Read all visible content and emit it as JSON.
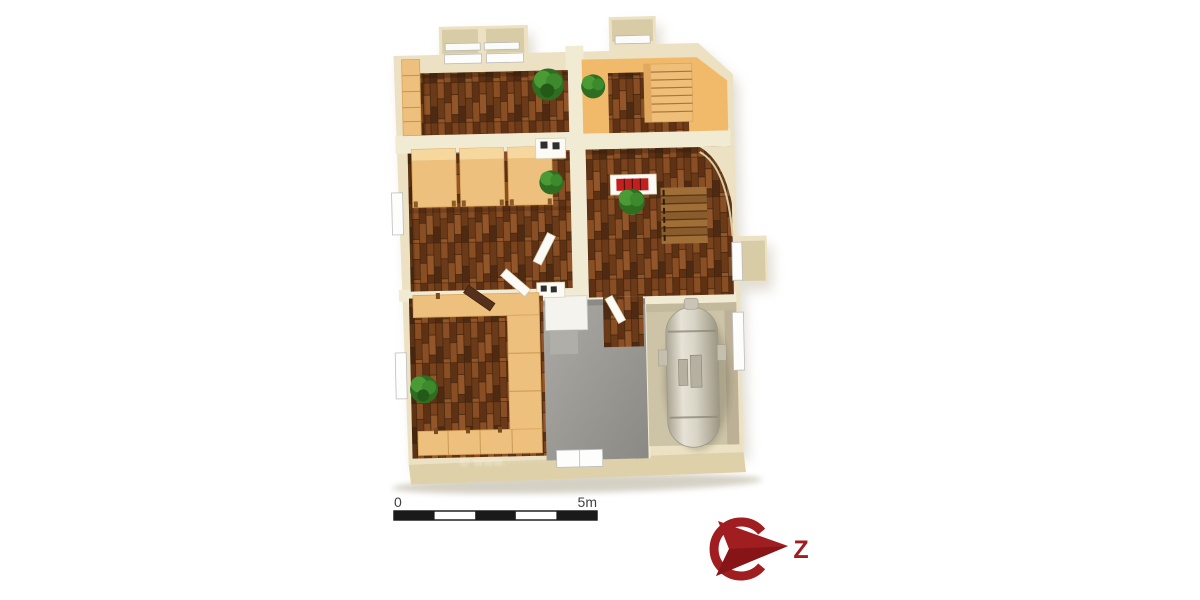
{
  "render": {
    "background": "#ffffff",
    "watermark_text": "© www.············"
  },
  "scale_bar": {
    "start_label": "0",
    "end_label": "5m",
    "segments": 5,
    "meters_total": 5,
    "dark_color": "#1a1a1a",
    "light_color": "#ffffff",
    "text_color": "#3f3f3f"
  },
  "compass": {
    "letter": "Z",
    "color": "#a01d20",
    "dark_color": "#871518"
  },
  "palette": {
    "wall": "#ece1c2",
    "wall_light": "#f2ebd4",
    "wall_shadow": "#d8cca6",
    "wall_front": "#ded1aa",
    "wood_dark": "#6f3c1b",
    "wood_furniture": "#eec07e",
    "floor_orange": "#f0ba6a",
    "floor_gray": "#9b9995",
    "floor_tank_room": "#cdc4a8",
    "plant_green": "#3f8f2c",
    "fireplace_red": "#c41f1f",
    "tank_metal": "#d6d2c4"
  },
  "floor_plan": {
    "rooms": [
      {
        "name": "bedroom-top-left",
        "floor": "dark-wood"
      },
      {
        "name": "room-top-right",
        "floor": "dark-wood-with-orange-border"
      },
      {
        "name": "bedroom-middle-left",
        "floor": "dark-wood"
      },
      {
        "name": "stair-hall",
        "floor": "dark-wood"
      },
      {
        "name": "room-bottom-left",
        "floor": "dark-wood"
      },
      {
        "name": "hallway",
        "floor": "gray"
      },
      {
        "name": "utility-tank-room",
        "floor": "beige"
      }
    ],
    "features": [
      "dormer-windows",
      "wall-shelf",
      "slatted-bench",
      "beds",
      "fireplace",
      "plants",
      "stairs",
      "arched-wall",
      "corner-benches",
      "cabinet",
      "oil-tank",
      "chimney-flues"
    ]
  }
}
